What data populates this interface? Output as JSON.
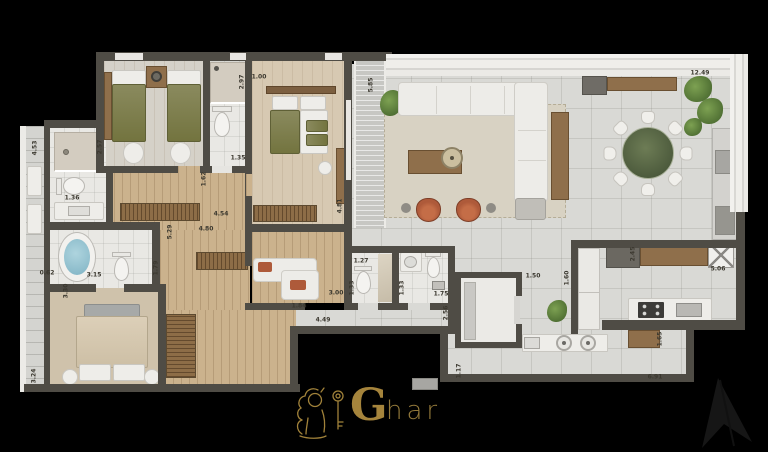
{
  "brand": {
    "g": "G",
    "har": "har",
    "mark": "lion-with-key-icon"
  },
  "plan": {
    "dimension_labels": [
      {
        "text": "2.57",
        "x": 100,
        "y": 147,
        "v": 1
      },
      {
        "text": "2.97",
        "x": 242,
        "y": 82,
        "v": 1
      },
      {
        "text": "1.00",
        "x": 259,
        "y": 77,
        "v": 0
      },
      {
        "text": "1.35",
        "x": 238,
        "y": 158,
        "v": 0
      },
      {
        "text": "1.62",
        "x": 204,
        "y": 179,
        "v": 1
      },
      {
        "text": "5.85",
        "x": 371,
        "y": 85,
        "v": 1
      },
      {
        "text": "4.81",
        "x": 340,
        "y": 206,
        "v": 1
      },
      {
        "text": "4.54",
        "x": 221,
        "y": 214,
        "v": 0
      },
      {
        "text": "4.80",
        "x": 206,
        "y": 229,
        "v": 0
      },
      {
        "text": "5.29",
        "x": 170,
        "y": 232,
        "v": 1
      },
      {
        "text": "12.49",
        "x": 700,
        "y": 73,
        "v": 0
      },
      {
        "text": "4.53",
        "x": 35,
        "y": 148,
        "v": 1
      },
      {
        "text": "1.36",
        "x": 72,
        "y": 198,
        "v": 0
      },
      {
        "text": "0.62",
        "x": 47,
        "y": 273,
        "v": 0
      },
      {
        "text": "3.15",
        "x": 94,
        "y": 275,
        "v": 0
      },
      {
        "text": "1.79",
        "x": 156,
        "y": 268,
        "v": 1
      },
      {
        "text": "3.30",
        "x": 66,
        "y": 291,
        "v": 1
      },
      {
        "text": "3.24",
        "x": 34,
        "y": 376,
        "v": 1
      },
      {
        "text": "1.27",
        "x": 361,
        "y": 261,
        "v": 0
      },
      {
        "text": "1.33",
        "x": 352,
        "y": 288,
        "v": 1
      },
      {
        "text": "3.00",
        "x": 336,
        "y": 293,
        "v": 0
      },
      {
        "text": "1.84",
        "x": 299,
        "y": 306,
        "v": 0
      },
      {
        "text": "4.49",
        "x": 323,
        "y": 320,
        "v": 0
      },
      {
        "text": "1.33",
        "x": 402,
        "y": 288,
        "v": 1
      },
      {
        "text": "1.75",
        "x": 441,
        "y": 294,
        "v": 0
      },
      {
        "text": "2.56",
        "x": 446,
        "y": 313,
        "v": 1
      },
      {
        "text": "1.50",
        "x": 533,
        "y": 276,
        "v": 0
      },
      {
        "text": "1.60",
        "x": 567,
        "y": 278,
        "v": 1
      },
      {
        "text": "2.45",
        "x": 633,
        "y": 254,
        "v": 1
      },
      {
        "text": "5.06",
        "x": 718,
        "y": 269,
        "v": 0
      },
      {
        "text": "1.17",
        "x": 459,
        "y": 371,
        "v": 1
      },
      {
        "text": "6.91",
        "x": 655,
        "y": 377,
        "v": 0
      },
      {
        "text": "1.65",
        "x": 660,
        "y": 339,
        "v": 1
      }
    ]
  },
  "colors": {
    "bg": "#000000",
    "wall": "#4f4c45",
    "tile": "#d9d9d5",
    "wood": "#cbb28d",
    "tan": "#d7c9b2",
    "carpet": "#cfc2ab",
    "bath": "#e9e8e4",
    "woodfurn": "#8f6f4b",
    "olive": "#7e7f52",
    "terracotta": "#ae5a3a",
    "plantc": "#4f6f33",
    "marble": "#5c6b49",
    "gold": "#a5843c"
  }
}
